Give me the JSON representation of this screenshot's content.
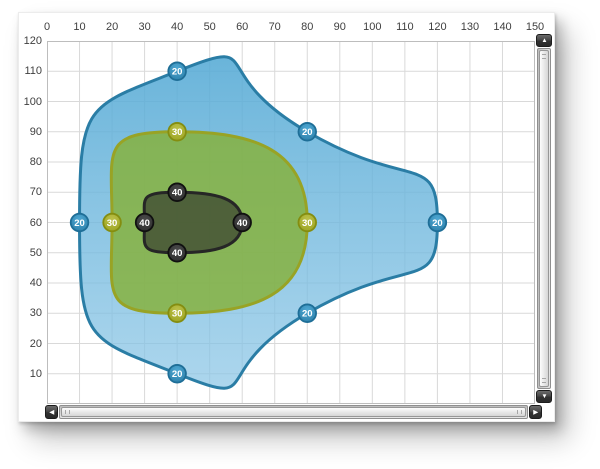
{
  "scrollbar": {
    "up_icon": "▲",
    "down_icon": "▼",
    "left_icon": "◀",
    "right_icon": "▶"
  },
  "chart_data": {
    "type": "area",
    "subtype": "smooth-contour-levels",
    "title": "",
    "grid": true,
    "legend": "none",
    "x_axis": {
      "position": "top",
      "min": 0,
      "max": 150,
      "step": 10,
      "tick_labels": [
        "0",
        "10",
        "20",
        "30",
        "40",
        "50",
        "60",
        "70",
        "80",
        "90",
        "100",
        "110",
        "120",
        "130",
        "140",
        "150"
      ]
    },
    "y_axis": {
      "position": "left",
      "min": 0,
      "max": 120,
      "step": 10,
      "tick_labels": [
        "120",
        "110",
        "100",
        "90",
        "80",
        "70",
        "60",
        "50",
        "40",
        "30",
        "20",
        "10"
      ]
    },
    "colors": {
      "grid": "#d9d9d9",
      "plot_border": "#bdbdbd",
      "tick_text": "#3f3f3f",
      "background": "#ffffff"
    },
    "series": [
      {
        "name": "contour-level-20",
        "label": "20",
        "stroke": "#2a7da5",
        "fill_top": "#55aad5",
        "fill_bottom": "#8cc6e6",
        "fill_opacity_top": 0.88,
        "fill_opacity_bottom": 0.72,
        "marker_fill_light": "#4fa8d3",
        "marker_fill_dark": "#2b7fa9",
        "marker_ring": "#1e6e97",
        "points": [
          [
            10,
            60
          ],
          [
            40,
            110
          ],
          [
            80,
            90
          ],
          [
            120,
            60
          ],
          [
            80,
            30
          ],
          [
            40,
            10
          ]
        ]
      },
      {
        "name": "contour-level-30",
        "label": "30",
        "stroke": "#98a325",
        "fill": "#86b23e",
        "fill_opacity": 0.85,
        "marker_fill_light": "#bcc14a",
        "marker_fill_dark": "#9ba320",
        "marker_ring": "#848d10",
        "points": [
          [
            20,
            60
          ],
          [
            40,
            90
          ],
          [
            80,
            60
          ],
          [
            40,
            30
          ]
        ]
      },
      {
        "name": "contour-level-40",
        "label": "40",
        "stroke": "#262626",
        "fill": "#2a2a26",
        "fill_opacity": 0.6,
        "marker_fill_light": "#4a4a4a",
        "marker_fill_dark": "#2d2d2d",
        "marker_ring": "#101010",
        "points": [
          [
            30,
            60
          ],
          [
            40,
            70
          ],
          [
            60,
            60
          ],
          [
            40,
            50
          ]
        ]
      }
    ]
  }
}
